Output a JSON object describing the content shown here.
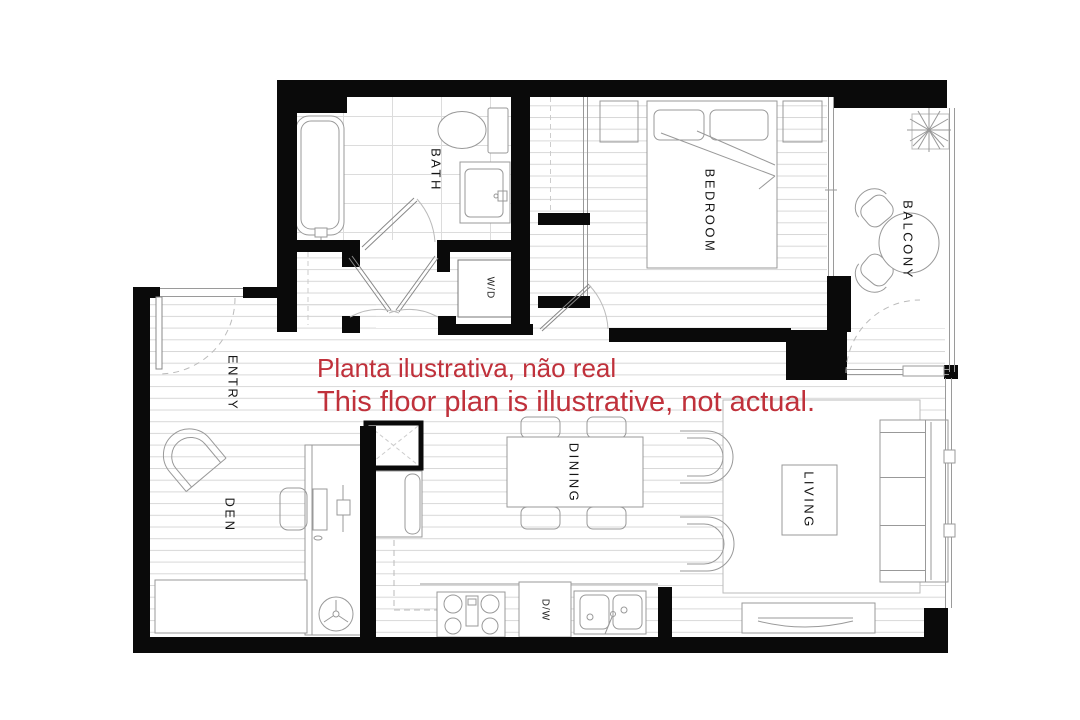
{
  "annotation": {
    "line1": "Planta ilustrativa, não real",
    "line2": "This floor plan is illustrative, not actual."
  },
  "rooms": {
    "bath": "BATH",
    "bedroom": "BEDROOM",
    "balcony": "BALCONY",
    "entry": "ENTRY",
    "den": "DEN",
    "dining": "DINING",
    "living": "LIVING"
  },
  "appliances": {
    "washer_dryer": "W/D",
    "dishwasher": "D/W"
  },
  "colors": {
    "wall": "#0a0a0a",
    "furniture_line": "#999999",
    "floor_line": "#d8d8d8",
    "annotation_red": "#c0313b",
    "background": "#ffffff"
  }
}
